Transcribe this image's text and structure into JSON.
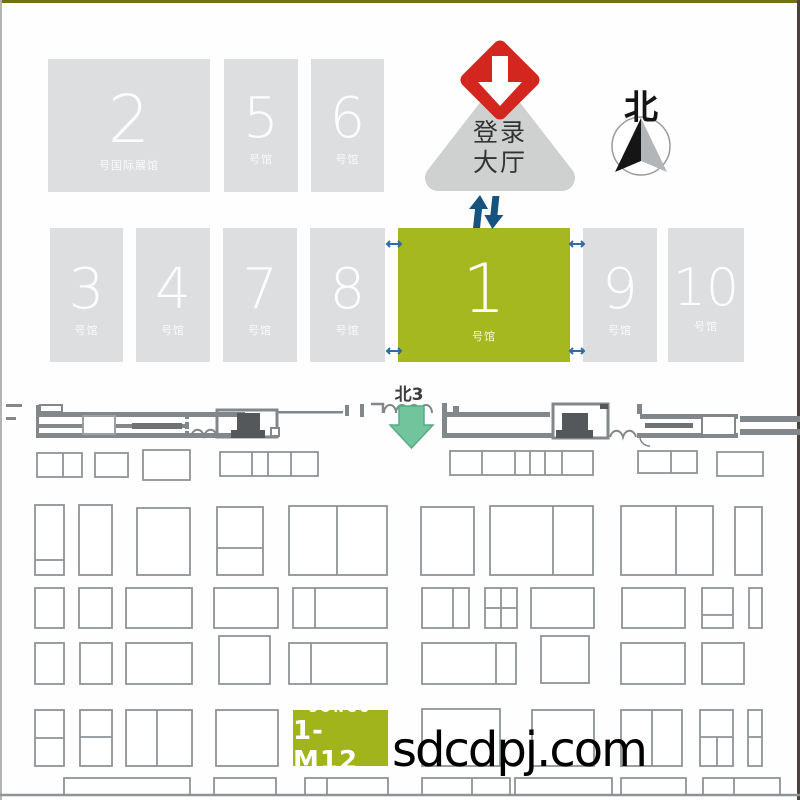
{
  "title": "exhibition-ground-plan",
  "halls": {
    "top_row": [
      {
        "num": "2",
        "label": "号国际展馆"
      },
      {
        "num": "5",
        "label": "号馆"
      },
      {
        "num": "6",
        "label": "号馆"
      }
    ],
    "main_row": [
      {
        "num": "3",
        "label": "号馆"
      },
      {
        "num": "4",
        "label": "号馆"
      },
      {
        "num": "7",
        "label": "号馆"
      },
      {
        "num": "8",
        "label": "号馆"
      },
      {
        "num": "1",
        "label": "号馆",
        "highlighted": true
      },
      {
        "num": "9",
        "label": "号馆"
      },
      {
        "num": "10",
        "label": "号馆"
      }
    ]
  },
  "landmarks": {
    "registration_hall": {
      "line1": "登录",
      "line2": "大厅"
    },
    "north_label": "北",
    "gate_label": "北3"
  },
  "booth": {
    "brand": "SONGU",
    "code": "1-M12"
  },
  "watermark": "sdcdpj.com",
  "icons": {
    "entrance": "red-diamond-down-arrow",
    "escalator": "blue-up-down-arrows",
    "compass": "north-needle-in-circle",
    "gate_arrow": "green-down-arrow",
    "hall_doors": "blue-double-arrow"
  },
  "colors": {
    "hall_gray": "#dcdedf",
    "highlight_green": "#a6b81f",
    "booth_green": "#a1b41c",
    "entrance_red": "#d3261f",
    "escalator_blue": "#16537e",
    "gate_arrow_green": "#72c49c",
    "outline_gray": "#82878b",
    "grid_gray": "#8f9396"
  }
}
